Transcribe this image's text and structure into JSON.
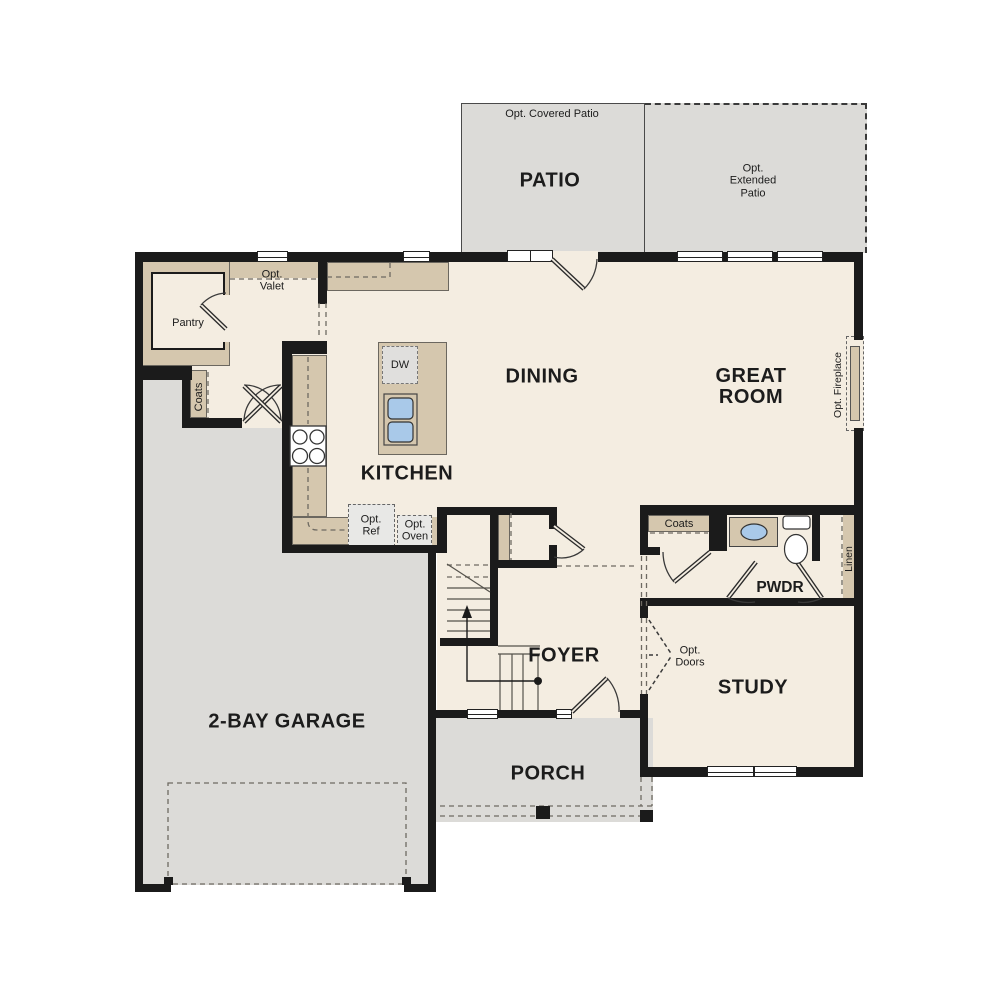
{
  "plan": {
    "rooms": {
      "patio": "PATIO",
      "dining": "DINING",
      "great_room": "GREAT ROOM",
      "kitchen": "KITCHEN",
      "foyer": "FOYER",
      "study": "STUDY",
      "porch": "PORCH",
      "garage": "2-BAY GARAGE",
      "pwdr": "PWDR"
    },
    "labels": {
      "opt_covered_patio": "Opt. Covered Patio",
      "opt_extended_patio": "Opt. Extended Patio",
      "pantry": "Pantry",
      "opt_valet": "Opt. Valet",
      "coats_mud": "Coats",
      "coats_foyer": "Coats",
      "dw": "DW",
      "opt_ref": "Opt. Ref",
      "opt_oven": "Opt. Oven",
      "opt_fireplace": "Opt. Fireplace",
      "linen": "Linen",
      "opt_doors": "Opt. Doors"
    },
    "colors": {
      "interior_cream": "#f4ede1",
      "exterior_gray": "#dcdbd8",
      "cabinet_tan": "#d5c7ae",
      "wall_black": "#1b1b1b",
      "appliance_gray": "#e8e8e6",
      "sink_blue": "#a9c9e9"
    }
  }
}
